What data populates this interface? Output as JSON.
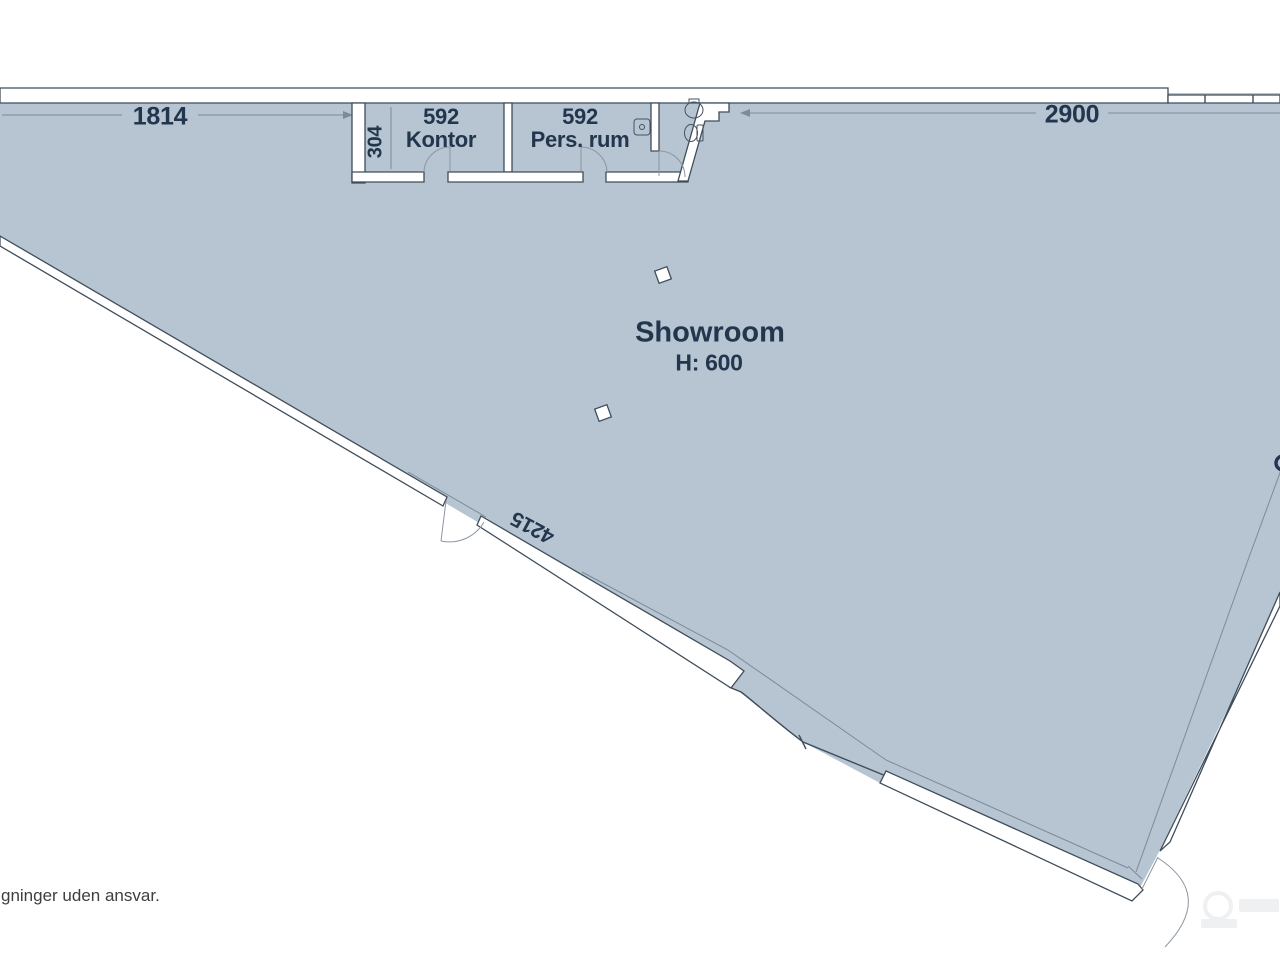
{
  "plan": {
    "rooms": {
      "showroom": {
        "name": "Showroom",
        "height_label": "H: 600"
      },
      "kontor": {
        "area": "592",
        "name": "Kontor"
      },
      "pers_rum": {
        "area": "592",
        "name": "Pers. rum"
      }
    },
    "dimensions": {
      "top_left_wall": "1814",
      "top_right_wall": "2900",
      "room_depth": "304",
      "diagonal_wall": "4215"
    }
  },
  "footer": {
    "disclaimer": "gninger uden ansvar."
  },
  "colors": {
    "floor_fill": "#b7c4d1",
    "wall_fill": "#ffffff",
    "wall_line": "#3f4d5a",
    "label_text": "#22364e",
    "dimension_line": "#7c8b99",
    "disclaimer_text": "#3e3e3e",
    "background": "#ffffff",
    "watermark": "#eef0f2"
  }
}
